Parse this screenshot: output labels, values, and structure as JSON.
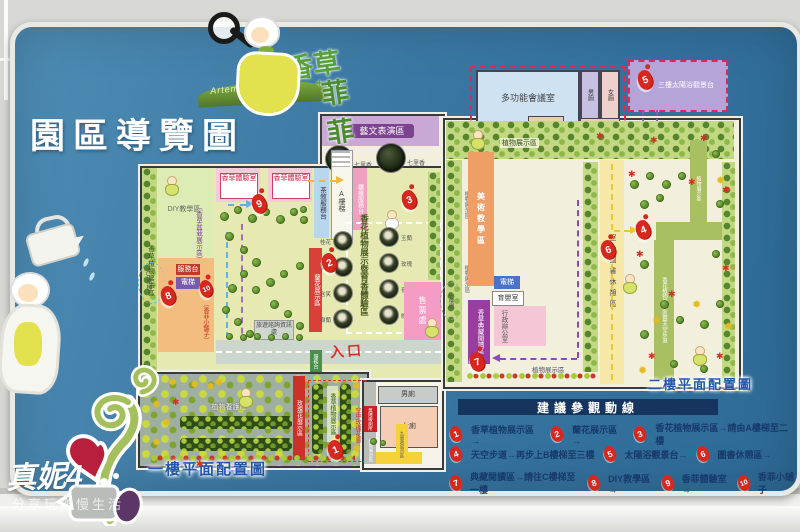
{
  "watermark": {
    "line1": "真妮4",
    "line2": "分享玩樂慢生活"
  },
  "logo": {
    "brand_1": "香草",
    "brand_2": "菲菲",
    "plus": "+",
    "subtitle": "Artemis Garden"
  },
  "title": "園區導覽圖",
  "floor1": {
    "caption": "一樓平面配置圖",
    "art_zone": "藝文表演區",
    "tree_photo": "七里香",
    "scent_room": "香菲體驗室",
    "tea_desk": "茶敘服務台",
    "stairs_a": "A樓梯",
    "counter": "櫃檯服務台",
    "herb_strip": "香草植物展示區",
    "diy": "DIY教學區",
    "herb_pots": "〔香草盆栽展示區〕",
    "shop_tag": "〔香菲小舖子〕",
    "service_desk": "服務台",
    "elevator": "電梯",
    "stairs_c": "C樓梯",
    "orchid_strip": "蘭花展示區",
    "scent_center": "香花植物展示暨育香體驗區",
    "info_desk": "旅遊諮詢資訊處",
    "entrance": "入口",
    "gate_desk": "服務台",
    "ticket": "售票處",
    "flowers": [
      "桂花",
      "茉莉",
      "含笑",
      "樹蘭",
      "玉蘭",
      "玫瑰",
      "夜香木",
      "晚香玉"
    ],
    "garden": {
      "care": "植物養護區",
      "rose_strip": "玫瑰花展示區",
      "herb_box": "香草植物展示區",
      "sky_rose": "空中玫瑰花廊",
      "pergola": "九重葛展示區",
      "plant_small": "植物展示區",
      "men": "男廁",
      "women": "女廁",
      "accessible": "無障礙廁所"
    }
  },
  "floor2": {
    "caption": "二樓平面配置圖",
    "meeting": "多功能會議室",
    "men": "男廁",
    "women": "女廁",
    "deck": "三樓太陽浴觀景台",
    "stairs_b": "B樓梯",
    "plant_label": "植物展示區",
    "class_strip": "美術教學區",
    "elevator": "電梯",
    "nursing": "育嬰室",
    "admin": "行政辦公室",
    "reading_strip": "香草典藏閱讀區",
    "stairs_c": "C樓梯",
    "book_strip": "室內圖書休憩區",
    "skywalk": "香花植物展示區暨天空步道",
    "path_label": "植物展示區"
  },
  "legend": {
    "title": "建議參觀動線",
    "items": [
      {
        "num": "1",
        "text": "香草植物展示區→"
      },
      {
        "num": "2",
        "text": "蘭花展示區→"
      },
      {
        "num": "3",
        "text": "香花植物展示區→請由A樓梯至二樓"
      },
      {
        "num": "4",
        "text": "天空步道→再步上B樓梯至三樓"
      },
      {
        "num": "5",
        "text": "太陽浴觀景台→"
      },
      {
        "num": "6",
        "text": "圖書休憩區→"
      },
      {
        "num": "7",
        "text": "典藏閱讀區→請往C樓梯至一樓"
      },
      {
        "num": "8",
        "text": "DIY教學區→"
      },
      {
        "num": "9",
        "text": "香菲體驗室→"
      },
      {
        "num": "10",
        "text": "香菲小舖子"
      }
    ]
  }
}
